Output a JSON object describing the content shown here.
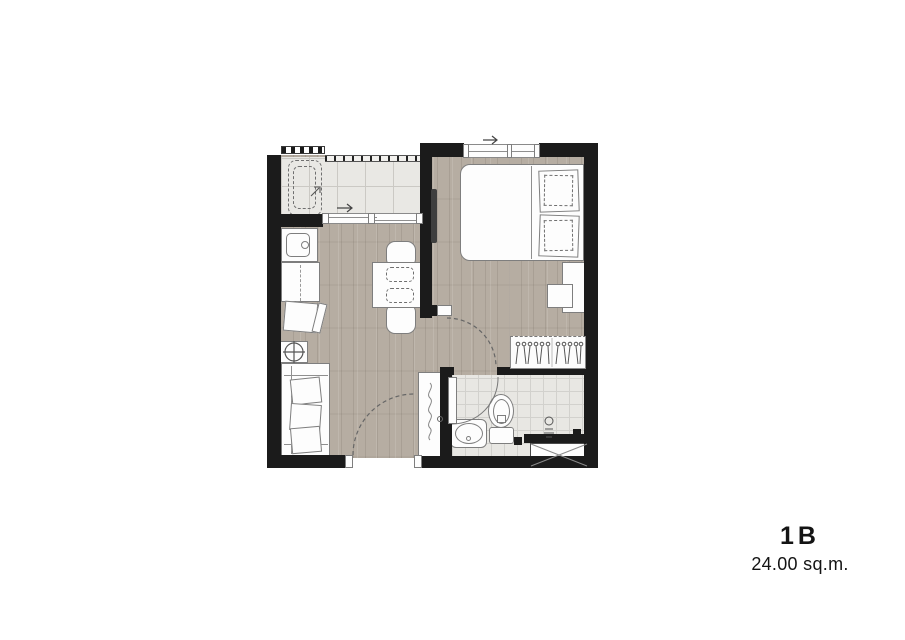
{
  "unit": {
    "name": "1B",
    "area": "24.00 sq.m."
  },
  "plan": {
    "type": "apartment-floor-plan",
    "rooms": [
      "balcony",
      "kitchen-living",
      "bedroom",
      "bathroom"
    ],
    "symbols": [
      "washing-machine",
      "kitchen-sink",
      "kitchen-counter",
      "cooktop-burner",
      "sofa",
      "dining-table",
      "dining-chair",
      "double-bed",
      "pillow",
      "tv",
      "desk",
      "stool",
      "wardrobe-hangers",
      "toilet",
      "bathroom-sink",
      "shower-tray",
      "entry-cabinet",
      "sliding-door",
      "window",
      "door-swing"
    ]
  },
  "palette": {
    "wall": "#1b1b1b",
    "wood_floor": "#b6ada2",
    "balcony_tile": "#e9e8e4",
    "bathroom_tile": "#e8e7e3",
    "furniture_fill": "#fdfdfd",
    "furniture_outline": "#7e7e7e",
    "text": "#141414",
    "background": "#ffffff"
  }
}
